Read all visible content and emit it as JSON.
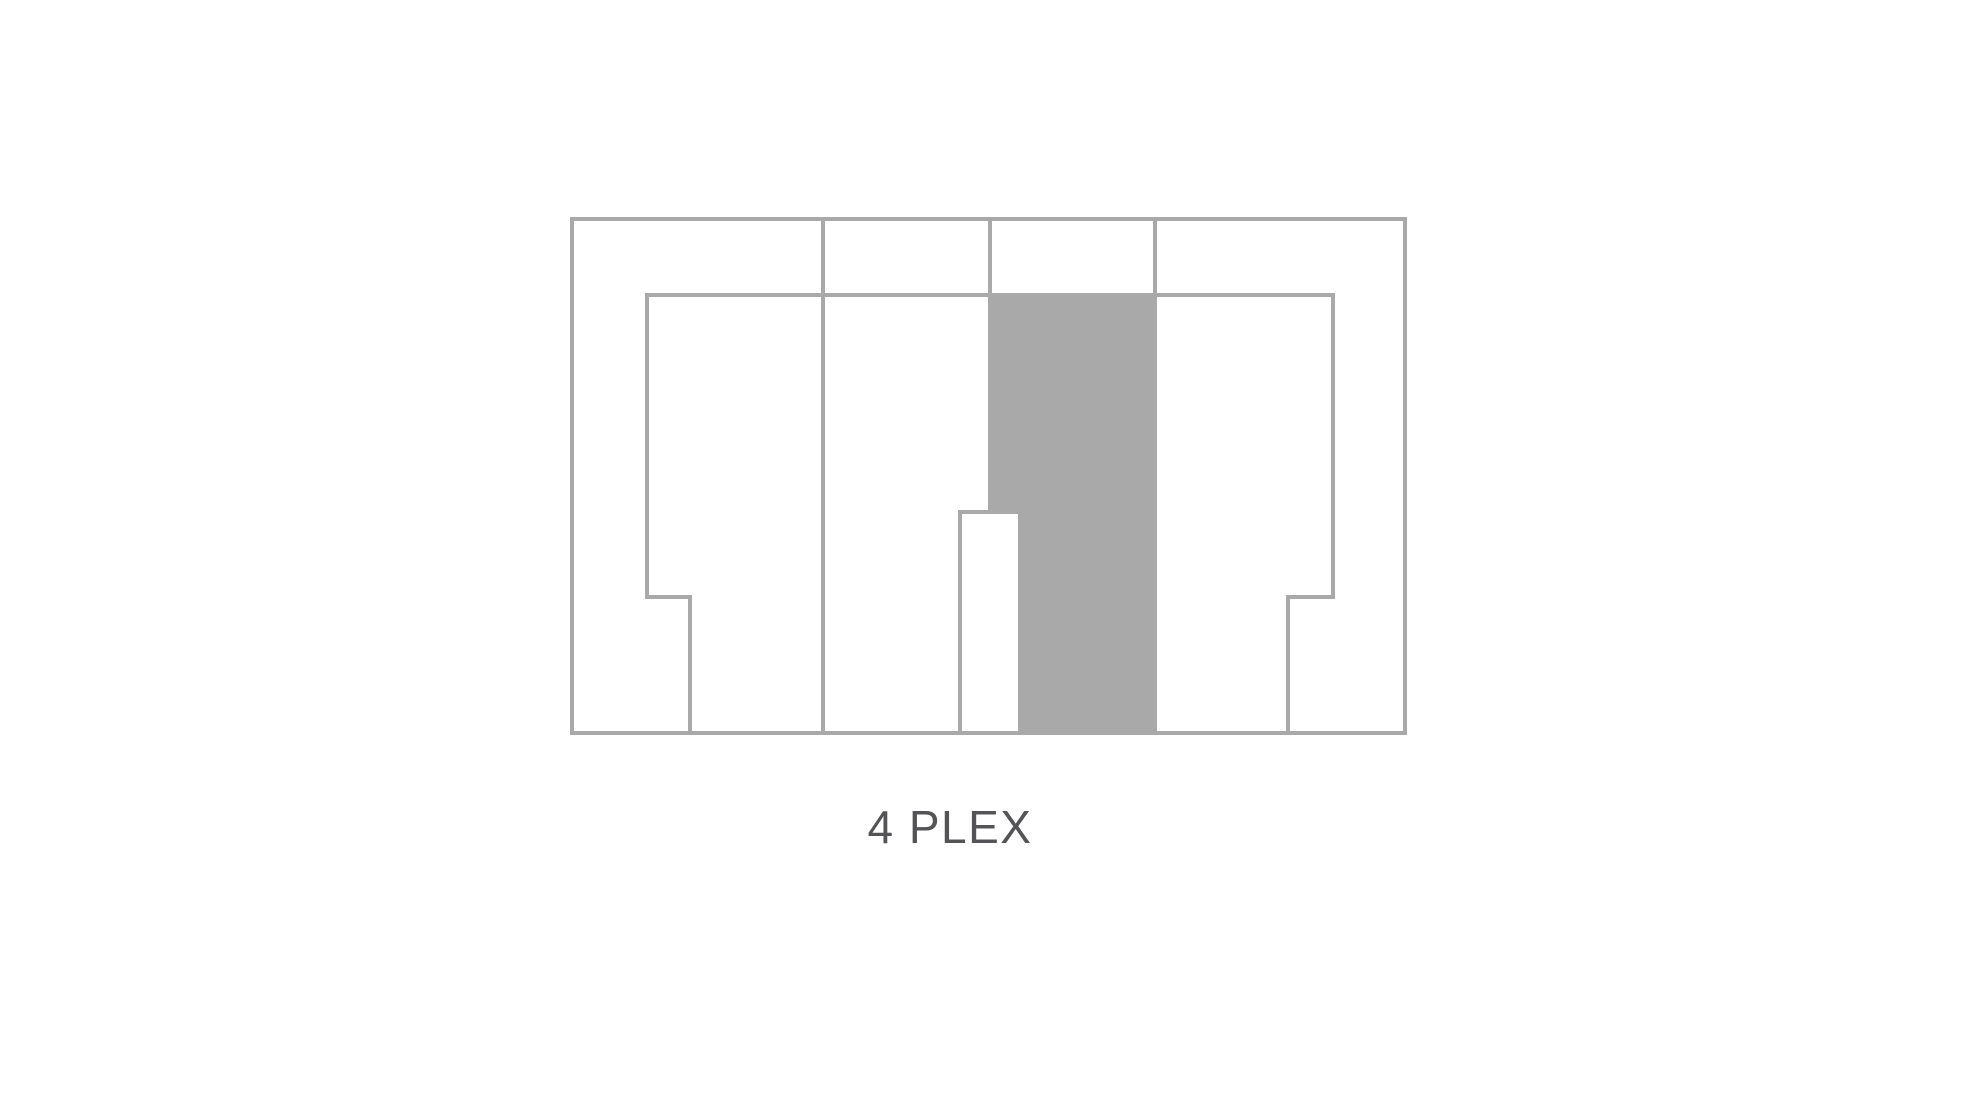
{
  "page": {
    "background": "#ffffff"
  },
  "colors": {
    "line": "#a9a9a9",
    "shaded_fill": "#a9a9a9",
    "interior_fill": "#ffffff",
    "caption_text": "#545457"
  },
  "diagram": {
    "type": "floor-plan-outline",
    "units": 4,
    "shaded_unit": "center-column"
  },
  "caption": {
    "text": "4 PLEX"
  }
}
